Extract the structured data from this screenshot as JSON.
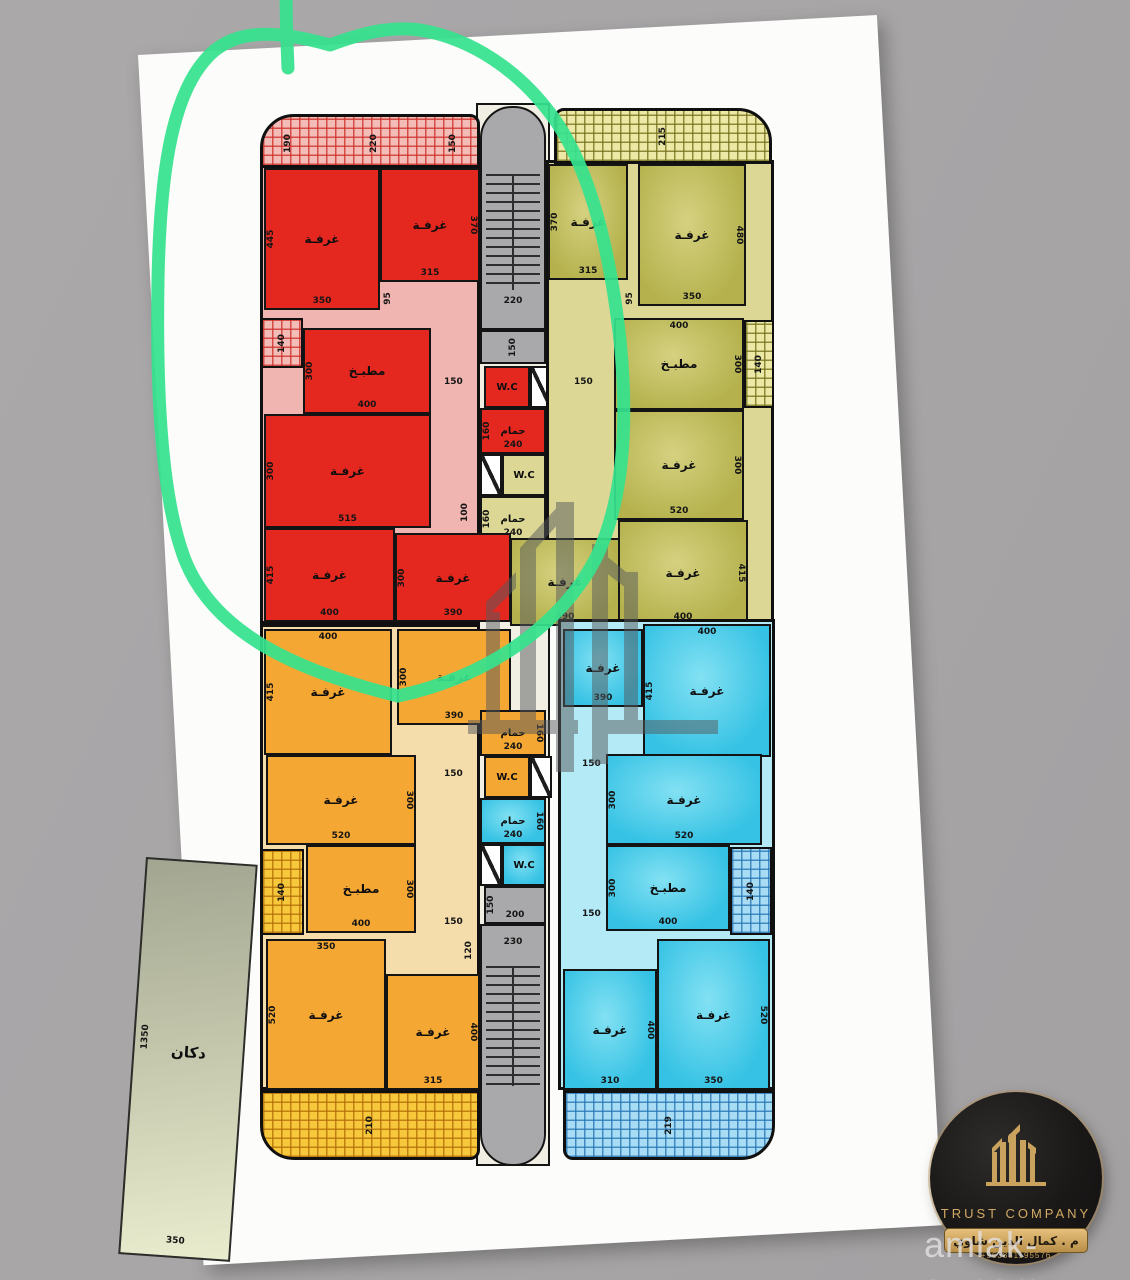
{
  "labels": {
    "room": "غرفـة",
    "kitchen": "مطبـخ",
    "bath": "حمام",
    "wc": "W.C",
    "shop": "دكان"
  },
  "shop": {
    "name": "دكان",
    "depth": "1350",
    "width": "350"
  },
  "stairs": {
    "top_width": "220",
    "top_landing": "150",
    "bottom_landing_side": "150",
    "bottom_landing": "200",
    "bottom_width": "230"
  },
  "red": {
    "balcony": [
      "190",
      "220",
      "150"
    ],
    "balcony_side": "140",
    "corridor": {
      "a": "95",
      "b": "150",
      "c": "100"
    },
    "r1": {
      "side": "445",
      "bottom": "350"
    },
    "r2": {
      "side": "370",
      "bottom": "315"
    },
    "kitchen": {
      "side": "300",
      "bottom": "400"
    },
    "r3": {
      "side": "300",
      "bottom": "515"
    },
    "r4": {
      "side": "415",
      "bottom": "400"
    },
    "r5": {
      "side": "300",
      "bottom": "390"
    },
    "bath": {
      "side": "160",
      "bottom": "240"
    }
  },
  "olive": {
    "balcony": "215",
    "balcony_side": "140",
    "corridor": {
      "a": "95",
      "b": "150"
    },
    "r1": {
      "side": "370",
      "bottom": "315"
    },
    "r2": {
      "side": "480",
      "bottom": "350"
    },
    "kitchen": {
      "top": "400",
      "side": "300"
    },
    "r3": {
      "side": "300",
      "bottom": "520"
    },
    "r4": {
      "side": "415",
      "bottom": "400"
    },
    "r5": {
      "bottom": "390"
    },
    "bath": {
      "side": "160",
      "bottom": "240"
    }
  },
  "orange": {
    "balcony": "210",
    "balcony_side": "140",
    "corridor": {
      "a": "150",
      "b": "150",
      "c": "120"
    },
    "r1": {
      "top": "400",
      "side": "415"
    },
    "r2": {
      "side": "300",
      "bottom": "390"
    },
    "r3": {
      "side": "300",
      "bottom": "520"
    },
    "kitchen": {
      "side": "300",
      "bottom": "400"
    },
    "r4": {
      "top": "350",
      "side": "520"
    },
    "r5": {
      "side": "400",
      "bottom": "315"
    },
    "bath": {
      "side": "160",
      "bottom": "240"
    }
  },
  "cyan": {
    "balcony": "219",
    "balcony_side": "140",
    "corridor": {
      "a": "150",
      "b": "150"
    },
    "r1": {
      "top": "400",
      "side": "415"
    },
    "r2": {
      "bottom": "390"
    },
    "r3": {
      "side": "300",
      "bottom": "520"
    },
    "kitchen": {
      "side": "300",
      "bottom": "400"
    },
    "r4": {
      "side": "400",
      "bottom": "310"
    },
    "r5": {
      "side": "520",
      "bottom": "350"
    },
    "bath": {
      "side": "160",
      "bottom": "240"
    }
  },
  "logo": {
    "company": "TRUST COMPANY",
    "engineer_ar": "م . كمال الدين شاوي",
    "phone": "+963831195576"
  },
  "watermark": {
    "site": "amlak-sy.com"
  }
}
